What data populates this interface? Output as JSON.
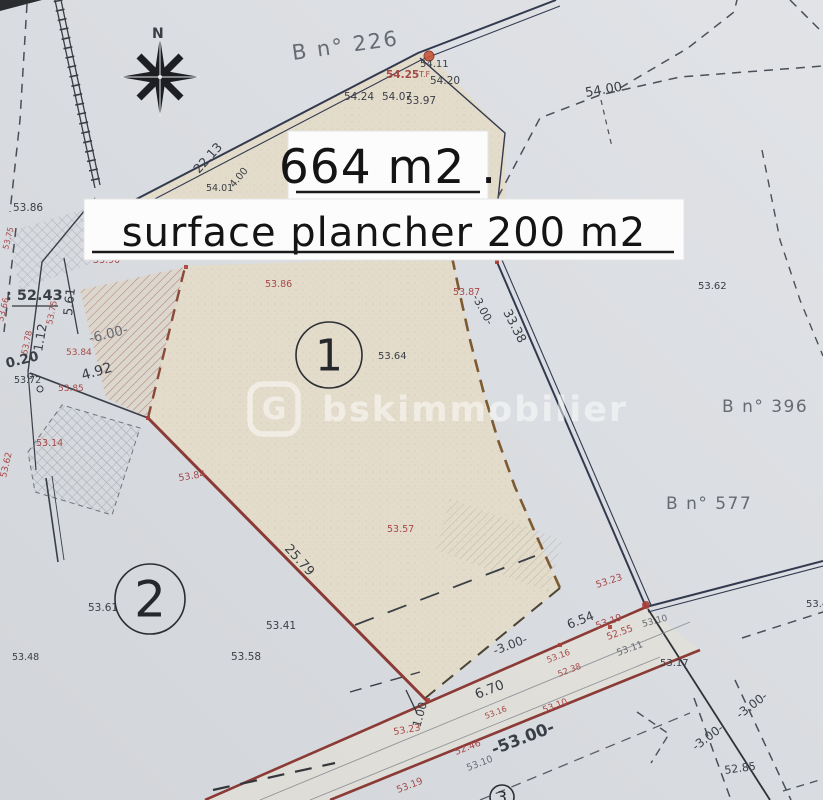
{
  "document": {
    "kind": "cadastral survey plan (scanned)",
    "area_label": "664 m2 .",
    "floor_area_label": "surface plancher 200 m2"
  },
  "watermark": {
    "logo_letter": "G",
    "text": "bskimmobilier"
  },
  "colors": {
    "d": "#3a3e46",
    "r": "#a84848",
    "g": "#666b73",
    "paper": "#d8dbdf",
    "parcel_fill": "#e3dccb",
    "road_ink": "#333a50",
    "boundary_red": "#8b3a35",
    "boundary_brown": "#7d5a32"
  },
  "parcel_markers": [
    {
      "n": "1",
      "x": 329,
      "y": 355,
      "rad": 33,
      "fs": 44
    },
    {
      "n": "2",
      "x": 150,
      "y": 599,
      "rad": 35,
      "fs": 50
    },
    {
      "n": "3",
      "x": 502,
      "y": 797,
      "rad": 12,
      "fs": 16
    }
  ],
  "labels": [
    {
      "t": "N",
      "x": 152,
      "y": 38,
      "s": 14,
      "c": "d",
      "b": true
    },
    {
      "t": "B n° 226",
      "x": 293,
      "y": 60,
      "s": 21,
      "c": "g",
      "r": -8,
      "ls": 2
    },
    {
      "t": "54.11",
      "x": 420,
      "y": 67,
      "s": 10,
      "c": "d"
    },
    {
      "t": "54.25",
      "x": 386,
      "y": 78,
      "s": 10.5,
      "c": "r",
      "b": true
    },
    {
      "t": "T.F",
      "x": 419,
      "y": 77,
      "s": 8,
      "c": "r"
    },
    {
      "t": "54.20",
      "x": 430,
      "y": 84,
      "s": 10.5,
      "c": "d"
    },
    {
      "t": "54.24",
      "x": 344,
      "y": 100,
      "s": 10.5,
      "c": "d"
    },
    {
      "t": "54.07",
      "x": 382,
      "y": 100,
      "s": 10.5,
      "c": "d"
    },
    {
      "t": "53.97",
      "x": 406,
      "y": 104,
      "s": 10.5,
      "c": "d"
    },
    {
      "t": "54.00",
      "x": 586,
      "y": 97,
      "s": 13,
      "c": "d",
      "r": -10
    },
    {
      "t": "22.13",
      "x": 199,
      "y": 174,
      "s": 12.5,
      "c": "d",
      "r": -48
    },
    {
      "t": "4.00",
      "x": 234,
      "y": 188,
      "s": 10,
      "c": "d",
      "r": -50
    },
    {
      "t": "54.01",
      "x": 206,
      "y": 191,
      "s": 9.5,
      "c": "d"
    },
    {
      "t": "53.86",
      "x": 13,
      "y": 211,
      "s": 10.5,
      "c": "d"
    },
    {
      "t": "53.75",
      "x": 8,
      "y": 250,
      "s": 8,
      "c": "r",
      "r": -76
    },
    {
      "t": "53.90",
      "x": 93,
      "y": 263,
      "s": 9.5,
      "c": "r"
    },
    {
      "t": ": 52.43",
      "x": 6,
      "y": 300,
      "s": 14.5,
      "c": "d",
      "b": true
    },
    {
      "t": "5.61",
      "x": 72,
      "y": 316,
      "s": 12.5,
      "c": "d",
      "r": -84
    },
    {
      "t": "53.66",
      "x": 3,
      "y": 322,
      "s": 8.5,
      "c": "r",
      "r": -76
    },
    {
      "t": "53.75",
      "x": 52,
      "y": 325,
      "s": 8.5,
      "c": "r",
      "r": -78
    },
    {
      "t": "53.86",
      "x": 265,
      "y": 287,
      "s": 9.5,
      "c": "r"
    },
    {
      "t": "53.87",
      "x": 453,
      "y": 295,
      "s": 9.5,
      "c": "r"
    },
    {
      "t": "-3.00-",
      "x": 472,
      "y": 297,
      "s": 11,
      "c": "d",
      "r": 62
    },
    {
      "t": "33.38",
      "x": 503,
      "y": 312,
      "s": 12.5,
      "c": "d",
      "r": 63
    },
    {
      "t": "53.62",
      "x": 698,
      "y": 289,
      "s": 10,
      "c": "d"
    },
    {
      "t": "-6.00-",
      "x": 90,
      "y": 343,
      "s": 13.5,
      "c": "g",
      "r": -14
    },
    {
      "t": "1.12",
      "x": 42,
      "y": 352,
      "s": 12.5,
      "c": "d",
      "r": -80
    },
    {
      "t": "53.78",
      "x": 27,
      "y": 355,
      "s": 8.5,
      "c": "r",
      "r": -78
    },
    {
      "t": "53.84",
      "x": 66,
      "y": 355,
      "s": 9,
      "c": "r"
    },
    {
      "t": "0.20",
      "x": 7,
      "y": 368,
      "s": 13.5,
      "c": "d",
      "r": -14,
      "b": true
    },
    {
      "t": "53.64",
      "x": 378,
      "y": 359,
      "s": 10,
      "c": "d"
    },
    {
      "t": "4.92",
      "x": 83,
      "y": 380,
      "s": 14,
      "c": "d",
      "r": -16
    },
    {
      "t": "53.72",
      "x": 14,
      "y": 383,
      "s": 9.5,
      "c": "d"
    },
    {
      "t": "53.85",
      "x": 58,
      "y": 391,
      "s": 9,
      "c": "r"
    },
    {
      "t": "B n° 396",
      "x": 722,
      "y": 412,
      "s": 17,
      "c": "g",
      "ls": 1.5
    },
    {
      "t": "53.14",
      "x": 36,
      "y": 446,
      "s": 9.5,
      "c": "r"
    },
    {
      "t": "53.62",
      "x": 6,
      "y": 478,
      "s": 9,
      "c": "r",
      "r": -77
    },
    {
      "t": "53.84",
      "x": 179,
      "y": 481,
      "s": 9.5,
      "c": "r",
      "r": -9
    },
    {
      "t": "B n° 577",
      "x": 666,
      "y": 509,
      "s": 17,
      "c": "g",
      "ls": 1.5
    },
    {
      "t": "53.57",
      "x": 387,
      "y": 532,
      "s": 9.5,
      "c": "r"
    },
    {
      "t": "25.79",
      "x": 284,
      "y": 549,
      "s": 13,
      "c": "d",
      "r": 48
    },
    {
      "t": "53.23",
      "x": 597,
      "y": 588,
      "s": 9.5,
      "c": "r",
      "r": -18
    },
    {
      "t": "53.61",
      "x": 88,
      "y": 611,
      "s": 10.5,
      "c": "d"
    },
    {
      "t": "53.41",
      "x": 266,
      "y": 629,
      "s": 10.5,
      "c": "d"
    },
    {
      "t": "6.54",
      "x": 569,
      "y": 629,
      "s": 12.5,
      "c": "d",
      "r": -21
    },
    {
      "t": "53.19",
      "x": 597,
      "y": 629,
      "s": 9.5,
      "c": "r",
      "r": -20
    },
    {
      "t": "53.10",
      "x": 643,
      "y": 627,
      "s": 9,
      "c": "g",
      "r": -15
    },
    {
      "t": "52.55",
      "x": 608,
      "y": 640,
      "s": 9.5,
      "c": "r",
      "r": -20
    },
    {
      "t": "-3.00-",
      "x": 495,
      "y": 655,
      "s": 12,
      "c": "d",
      "r": -21
    },
    {
      "t": "53.11",
      "x": 618,
      "y": 656,
      "s": 9.5,
      "c": "g",
      "r": -20
    },
    {
      "t": "53.48",
      "x": 12,
      "y": 660,
      "s": 9.5,
      "c": "d"
    },
    {
      "t": "53.58",
      "x": 231,
      "y": 660,
      "s": 10.5,
      "c": "d"
    },
    {
      "t": "53.16",
      "x": 548,
      "y": 663,
      "s": 8.5,
      "c": "r",
      "r": -21
    },
    {
      "t": "53.17",
      "x": 660,
      "y": 666,
      "s": 10,
      "c": "d"
    },
    {
      "t": "52.38",
      "x": 559,
      "y": 677,
      "s": 8.5,
      "c": "r",
      "r": -21
    },
    {
      "t": "6.70",
      "x": 477,
      "y": 699,
      "s": 13.5,
      "c": "d",
      "r": -21
    },
    {
      "t": "53.10",
      "x": 544,
      "y": 713,
      "s": 9,
      "c": "r",
      "r": -21
    },
    {
      "t": "53.16",
      "x": 486,
      "y": 719,
      "s": 8,
      "c": "r",
      "r": -21
    },
    {
      "t": "1.00",
      "x": 420,
      "y": 728,
      "s": 11.5,
      "c": "d",
      "r": -74
    },
    {
      "t": "53.23",
      "x": 394,
      "y": 735,
      "s": 9.5,
      "c": "r",
      "r": -10
    },
    {
      "t": "-3.00-",
      "x": 740,
      "y": 719,
      "s": 12,
      "c": "d",
      "r": -37
    },
    {
      "t": "52.46",
      "x": 456,
      "y": 755,
      "s": 9.5,
      "c": "r",
      "r": -21
    },
    {
      "t": "-53.00-",
      "x": 494,
      "y": 755,
      "s": 16.5,
      "c": "d",
      "r": -21,
      "b": true
    },
    {
      "t": "-3.00-",
      "x": 696,
      "y": 751,
      "s": 12,
      "c": "d",
      "r": -37
    },
    {
      "t": "53.10",
      "x": 468,
      "y": 771,
      "s": 9.5,
      "c": "g",
      "r": -21
    },
    {
      "t": "52.85",
      "x": 725,
      "y": 774,
      "s": 11,
      "c": "d",
      "r": -8
    },
    {
      "t": "53.19",
      "x": 398,
      "y": 793,
      "s": 9.5,
      "c": "r",
      "r": -21
    },
    {
      "t": "53.4",
      "x": 806,
      "y": 607,
      "s": 10,
      "c": "d"
    }
  ]
}
